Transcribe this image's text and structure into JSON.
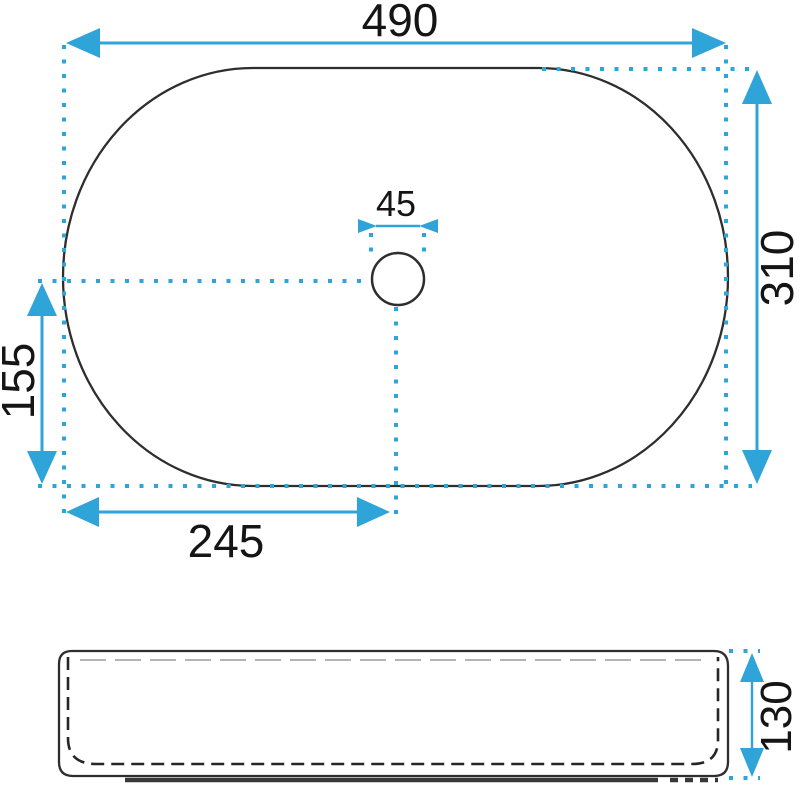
{
  "colors": {
    "dimension_blue": "#2ea4d9",
    "outline_dark": "#2e2e2e",
    "label_black": "#151515",
    "background": "#ffffff"
  },
  "top_view": {
    "width_label": "490",
    "depth_label": "310",
    "drain_label": "45",
    "vertical_offset_label": "155",
    "horizontal_offset_label": "245"
  },
  "side_view": {
    "height_label": "130"
  }
}
